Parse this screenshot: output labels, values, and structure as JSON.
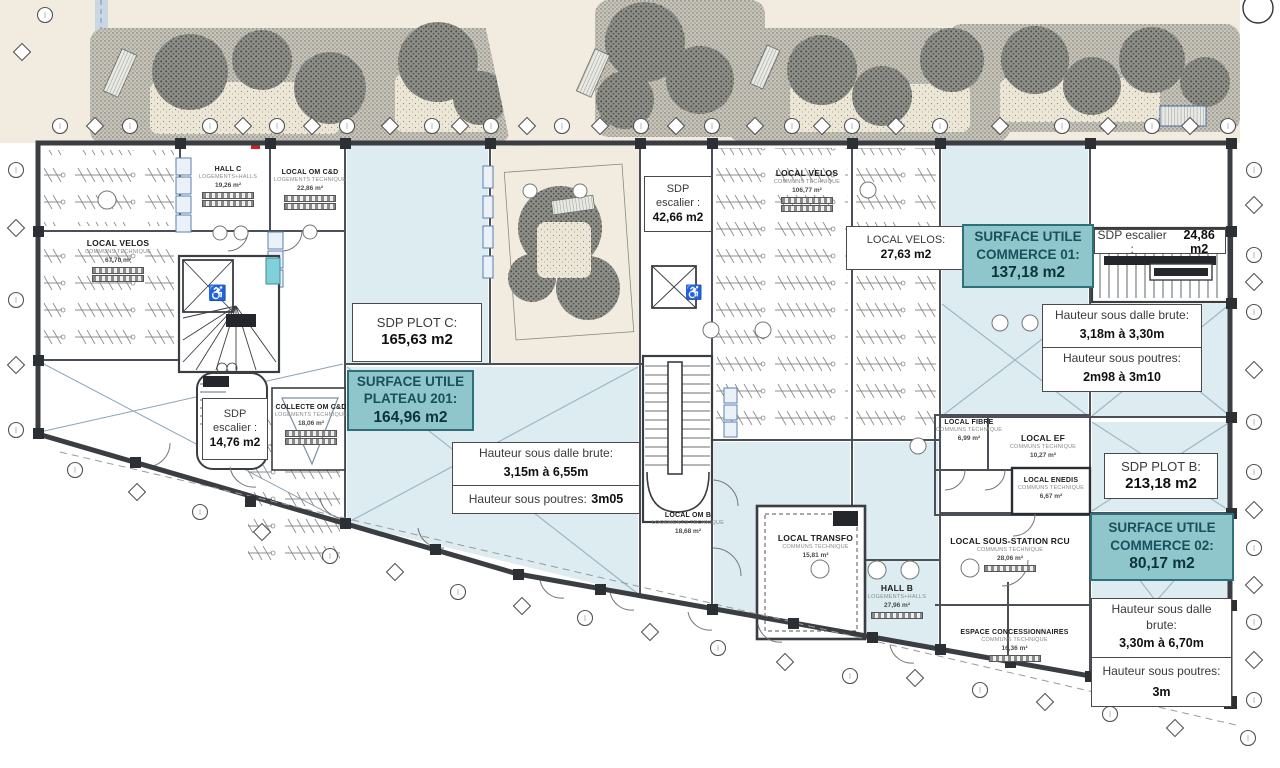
{
  "colors": {
    "teal_fill": "#8fc6cc",
    "teal_border": "#2f6f79",
    "teal_text": "#19505c",
    "room_blue": "#dcecf0",
    "wall": "#3a3d42",
    "ground": "#f1ecdf",
    "line_blue": "#8fb0c4"
  },
  "boxes": {
    "sdp_plot_c": {
      "l1": "SDP PLOT C:",
      "l2": "165,63 m2"
    },
    "su_plateau_201": {
      "l1": "SURFACE UTILE",
      "l2": "PLATEAU 201:",
      "l3": "164,96 m2"
    },
    "h_plateau": {
      "dalle": "Hauteur sous dalle brute:",
      "dalle_v": "3,15m à 6,55m",
      "poutres": "Hauteur sous poutres:",
      "poutres_v": "3m05"
    },
    "sdp_escalier_c": {
      "l1": "SDP",
      "l2": "escalier :",
      "l3": "42,66 m2"
    },
    "sdp_escalier_a": {
      "l1": "SDP",
      "l2": "escalier :",
      "l3": "14,76 m2"
    },
    "local_velos_b": {
      "l1": "LOCAL VELOS:",
      "l2": "27,63 m2"
    },
    "su_commerce_01": {
      "l1": "SURFACE UTILE",
      "l2": "COMMERCE 01:",
      "l3": "137,18 m2"
    },
    "sdp_escalier_b": {
      "label": "SDP escalier :",
      "value": "24,86 m2"
    },
    "h_commerce_01": {
      "dalle": "Hauteur sous dalle brute:",
      "dalle_v": "3,18m à 3,30m",
      "poutres": "Hauteur sous poutres:",
      "poutres_v": "2m98 à 3m10"
    },
    "sdp_plot_b": {
      "l1": "SDP PLOT B:",
      "l2": "213,18 m2"
    },
    "su_commerce_02": {
      "l1": "SURFACE UTILE",
      "l2": "COMMERCE 02:",
      "l3": "80,17 m2"
    },
    "h_commerce_02": {
      "dalle": "Hauteur sous dalle brute:",
      "dalle_v": "3,30m à 6,70m",
      "poutres": "Hauteur sous poutres:",
      "poutres_v": "3m"
    }
  },
  "rooms": {
    "hall_c": {
      "name": "HALL C",
      "category": "LOGEMENTS+HALLS",
      "area": "19,26 m²"
    },
    "om_cd": {
      "name": "LOCAL OM C&D",
      "category": "LOGEMENTS TECHNIQUE",
      "area": "22,86 m²"
    },
    "velos_a": {
      "name": "LOCAL VELOS",
      "category": "COMMUNS TECHNIQUE",
      "area": "67,70 m²"
    },
    "velos_c": {
      "name": "LOCAL VELOS",
      "category": "COMMUNS TECHNIQUE",
      "area": "106,77 m²"
    },
    "collecte": {
      "name": "COLLECTE OM C&D",
      "category": "LOGEMENTS TECHNIQUE",
      "area": "18,06 m²"
    },
    "om_b": {
      "name": "LOCAL OM B",
      "category": "LOGEMENTS TECHNIQUE",
      "area": "18,68 m²"
    },
    "transfo": {
      "name": "LOCAL TRANSFO",
      "category": "COMMUNS TECHNIQUE",
      "area": "15,81 m²"
    },
    "hall_b": {
      "name": "HALL B",
      "category": "LOGEMENTS+HALLS",
      "area": "27,96 m²"
    },
    "fibre": {
      "name": "LOCAL FIBRE",
      "category": "COMMUNS TECHNIQUE",
      "area": "6,99 m²"
    },
    "ef": {
      "name": "LOCAL EF",
      "category": "COMMUNS TECHNIQUE",
      "area": "10,27 m²"
    },
    "enedis": {
      "name": "LOCAL ENEDIS",
      "category": "COMMUNS TECHNIQUE",
      "area": "6,67 m²"
    },
    "rcu": {
      "name": "LOCAL SOUS-STATION RCU",
      "category": "COMMUNS TECHNIQUE",
      "area": "28,06 m²"
    },
    "concession": {
      "name": "ESPACE CONCESSIONNAIRES",
      "category": "COMMUNS TECHNIQUE",
      "area": "16,36 m²"
    }
  }
}
